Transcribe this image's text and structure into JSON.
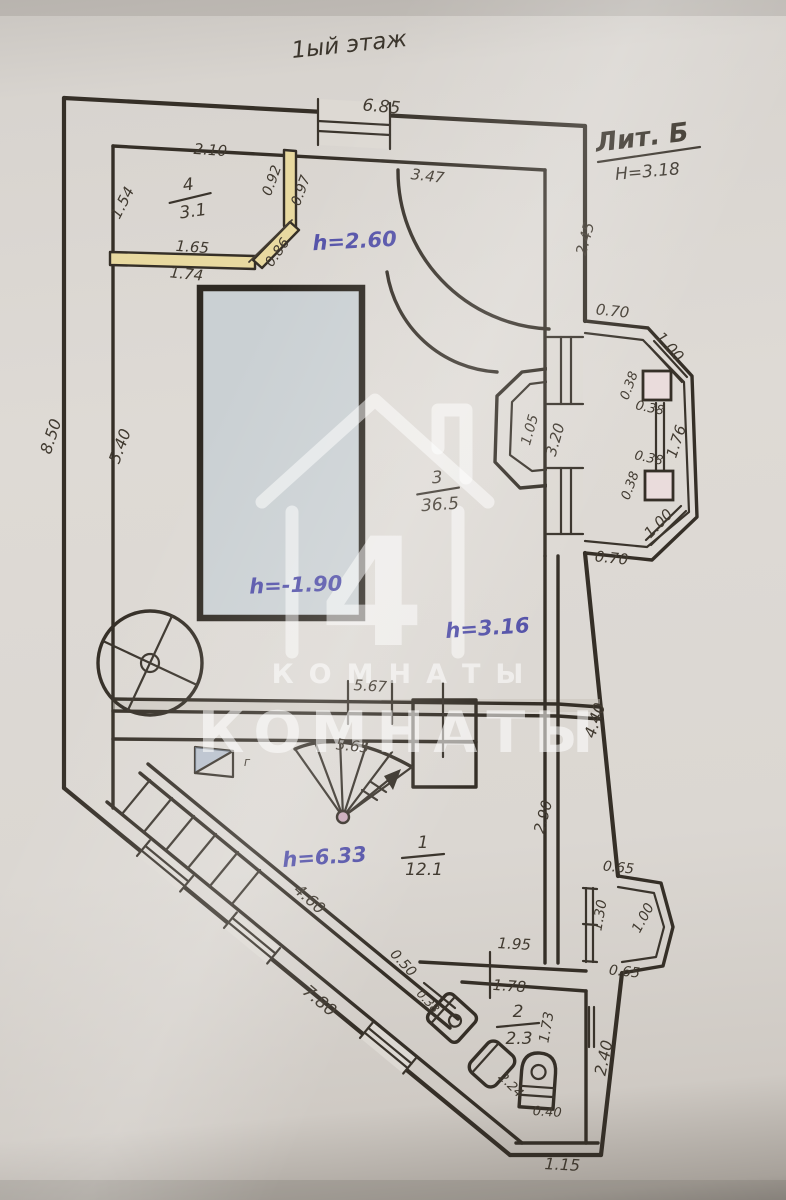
{
  "header": {
    "title": {
      "t": "1ый этаж",
      "x": 350,
      "y": 52,
      "r": -6
    },
    "lit": {
      "t": "Лит. Б",
      "x": 643,
      "y": 146,
      "r": -7
    },
    "note": {
      "t": "Н=3.18",
      "x": 648,
      "y": 177,
      "r": -5
    }
  },
  "rooms": [
    {
      "number": "4",
      "area": "3.1",
      "x": 190,
      "y": 197,
      "r": -8
    },
    {
      "number": "3",
      "area": "36.5",
      "x": 438,
      "y": 490,
      "r": -4
    },
    {
      "number": "1",
      "area": "12.1",
      "x": 423,
      "y": 855,
      "r": 0
    },
    {
      "number": "2",
      "area": "2.3",
      "x": 518,
      "y": 1024,
      "r": 0
    }
  ],
  "labels": {
    "blue": [
      {
        "t": "h=2.60",
        "x": 355,
        "y": 248,
        "r": -3
      },
      {
        "t": "h=-1.90",
        "x": 296,
        "y": 592,
        "r": -2
      },
      {
        "t": "h=3.16",
        "x": 488,
        "y": 635,
        "r": -4
      },
      {
        "t": "h=6.33",
        "x": 325,
        "y": 864,
        "r": -4
      }
    ],
    "pencil": [
      {
        "t": "6.85",
        "x": 381,
        "y": 112,
        "r": 5,
        "s": 17
      },
      {
        "t": "2.10",
        "x": 210,
        "y": 155,
        "r": 4,
        "s": 15
      },
      {
        "t": "1.54",
        "x": 127,
        "y": 205,
        "r": -63,
        "s": 15
      },
      {
        "t": "0.92",
        "x": 276,
        "y": 182,
        "r": -70,
        "s": 14
      },
      {
        "t": "0.97",
        "x": 305,
        "y": 192,
        "r": -70,
        "s": 14
      },
      {
        "t": "1.65",
        "x": 192,
        "y": 252,
        "r": 4,
        "s": 15
      },
      {
        "t": "0.86",
        "x": 281,
        "y": 255,
        "r": -55,
        "s": 14
      },
      {
        "t": "1.74",
        "x": 186,
        "y": 279,
        "r": 6,
        "s": 15
      },
      {
        "t": "3.47",
        "x": 427,
        "y": 181,
        "r": 7,
        "s": 15
      },
      {
        "t": "2.45",
        "x": 590,
        "y": 240,
        "r": -75,
        "s": 15
      },
      {
        "t": "0.70",
        "x": 612,
        "y": 316,
        "r": 6,
        "s": 15
      },
      {
        "t": "1.00",
        "x": 666,
        "y": 350,
        "r": 48,
        "s": 15
      },
      {
        "t": "0.38",
        "x": 633,
        "y": 387,
        "r": -70,
        "s": 13
      },
      {
        "t": "0.38",
        "x": 649,
        "y": 412,
        "r": 12,
        "s": 13
      },
      {
        "t": "1.76",
        "x": 681,
        "y": 443,
        "r": -72,
        "s": 15
      },
      {
        "t": "0.38",
        "x": 648,
        "y": 462,
        "r": 12,
        "s": 13
      },
      {
        "t": "0.38",
        "x": 634,
        "y": 487,
        "r": -70,
        "s": 13
      },
      {
        "t": "1.00",
        "x": 662,
        "y": 527,
        "r": -46,
        "s": 15
      },
      {
        "t": "0.70",
        "x": 611,
        "y": 563,
        "r": 6,
        "s": 15
      },
      {
        "t": "3.20",
        "x": 560,
        "y": 441,
        "r": -74,
        "s": 15
      },
      {
        "t": "1.05",
        "x": 534,
        "y": 431,
        "r": -74,
        "s": 14
      },
      {
        "t": "8.50",
        "x": 56,
        "y": 438,
        "r": -72,
        "s": 16
      },
      {
        "t": "5.40",
        "x": 125,
        "y": 448,
        "r": -70,
        "s": 16
      },
      {
        "t": "5.67",
        "x": 370,
        "y": 691,
        "r": 3,
        "s": 15
      },
      {
        "t": "5.65",
        "x": 352,
        "y": 751,
        "r": 6,
        "s": 15
      },
      {
        "t": "4.40",
        "x": 600,
        "y": 722,
        "r": -72,
        "s": 16
      },
      {
        "t": "2.90",
        "x": 548,
        "y": 818,
        "r": -75,
        "s": 15
      },
      {
        "t": "4.60",
        "x": 306,
        "y": 903,
        "r": 42,
        "s": 16
      },
      {
        "t": "0.65",
        "x": 618,
        "y": 872,
        "r": 6,
        "s": 14
      },
      {
        "t": "1.30",
        "x": 604,
        "y": 916,
        "r": -80,
        "s": 14
      },
      {
        "t": "1.00",
        "x": 647,
        "y": 920,
        "r": -62,
        "s": 14
      },
      {
        "t": "0.65",
        "x": 624,
        "y": 976,
        "r": 6,
        "s": 14
      },
      {
        "t": "1.95",
        "x": 514,
        "y": 949,
        "r": 3,
        "s": 15
      },
      {
        "t": "1.78",
        "x": 509,
        "y": 991,
        "r": 4,
        "s": 15
      },
      {
        "t": "0.50",
        "x": 400,
        "y": 966,
        "r": 47,
        "s": 14
      },
      {
        "t": "7.80",
        "x": 316,
        "y": 1005,
        "r": 40,
        "s": 17
      },
      {
        "t": "0.38",
        "x": 425,
        "y": 1004,
        "r": 47,
        "s": 12
      },
      {
        "t": "1.73",
        "x": 551,
        "y": 1028,
        "r": -80,
        "s": 14
      },
      {
        "t": "2.40",
        "x": 609,
        "y": 1059,
        "r": -78,
        "s": 16
      },
      {
        "t": "2.24",
        "x": 508,
        "y": 1088,
        "r": 45,
        "s": 13
      },
      {
        "t": "0.40",
        "x": 547,
        "y": 1116,
        "r": 4,
        "s": 13
      },
      {
        "t": "1.15",
        "x": 562,
        "y": 1170,
        "r": 3,
        "s": 16
      },
      {
        "t": "г",
        "x": 247,
        "y": 766,
        "r": 0,
        "s": 12
      }
    ]
  },
  "watermark": {
    "number": "4",
    "line1": "КОМНАТЫ",
    "line2": "КОМНАТЫ"
  },
  "colors": {
    "ink": "#352f27",
    "blue_pen": "#4c4aa6",
    "paper": "#dedad5",
    "highlight_wall": "#e8d9a0",
    "pool_fill": "#cad0d3",
    "pillar_fill": "#eadcdc"
  }
}
